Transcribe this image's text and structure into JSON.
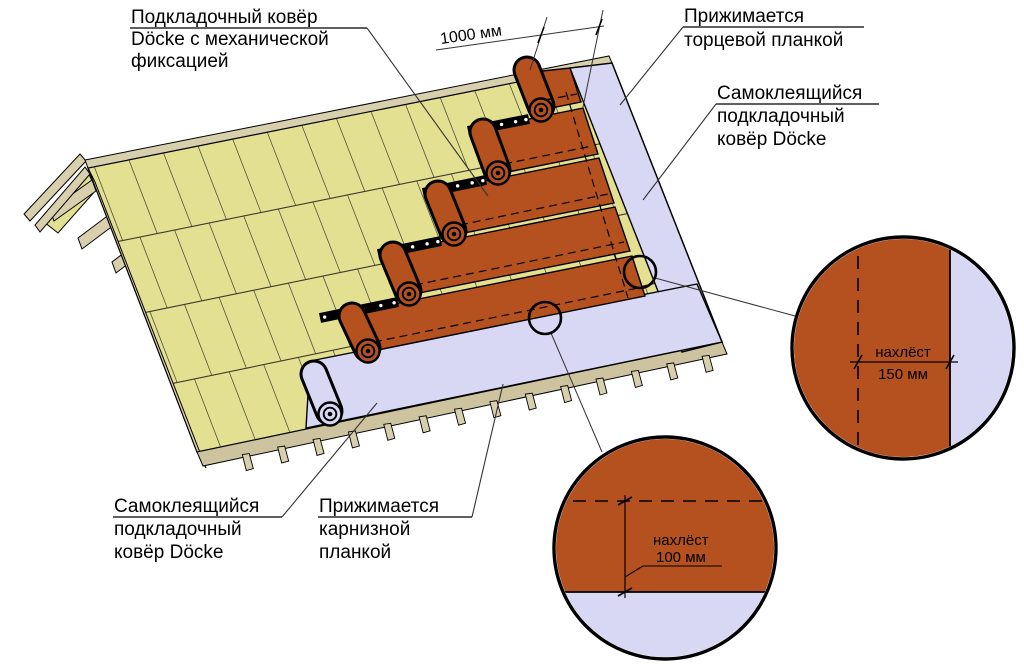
{
  "diagram": {
    "title_hint": "Installation of Döcke underlayment carpet on a roof slope",
    "labels": {
      "underlay_mech": {
        "l1": "Подкладочный ковёр",
        "l2": "Döcke с механической",
        "l3": "фиксацией"
      },
      "end_strip": {
        "l1": "Прижимается",
        "l2": "торцевой планкой"
      },
      "selfadh_right": {
        "l1": "Самоклеящийся",
        "l2": "подкладочный",
        "l3": "ковёр Döcke"
      },
      "selfadh_left": {
        "l1": "Самоклеящийся",
        "l2": "подкладочный",
        "l3": "ковёр Döcke"
      },
      "eaves_flash": {
        "l1": "Прижимается",
        "l2": "карнизной",
        "l3": "планкой"
      }
    },
    "dimensions": {
      "roll_width": "1000 мм",
      "overlap_side": {
        "word": "нахлёст",
        "value": "150 мм"
      },
      "overlap_course": {
        "word": "нахлёст",
        "value": "100 мм"
      }
    },
    "colors": {
      "deck": "#e3e092",
      "deck_line": "#55543c",
      "wood": "#d8cfac",
      "wood_dark": "#cdc49f",
      "sheet": "#b4511e",
      "lavender": "#d9d8f4",
      "line": "#000000"
    }
  }
}
